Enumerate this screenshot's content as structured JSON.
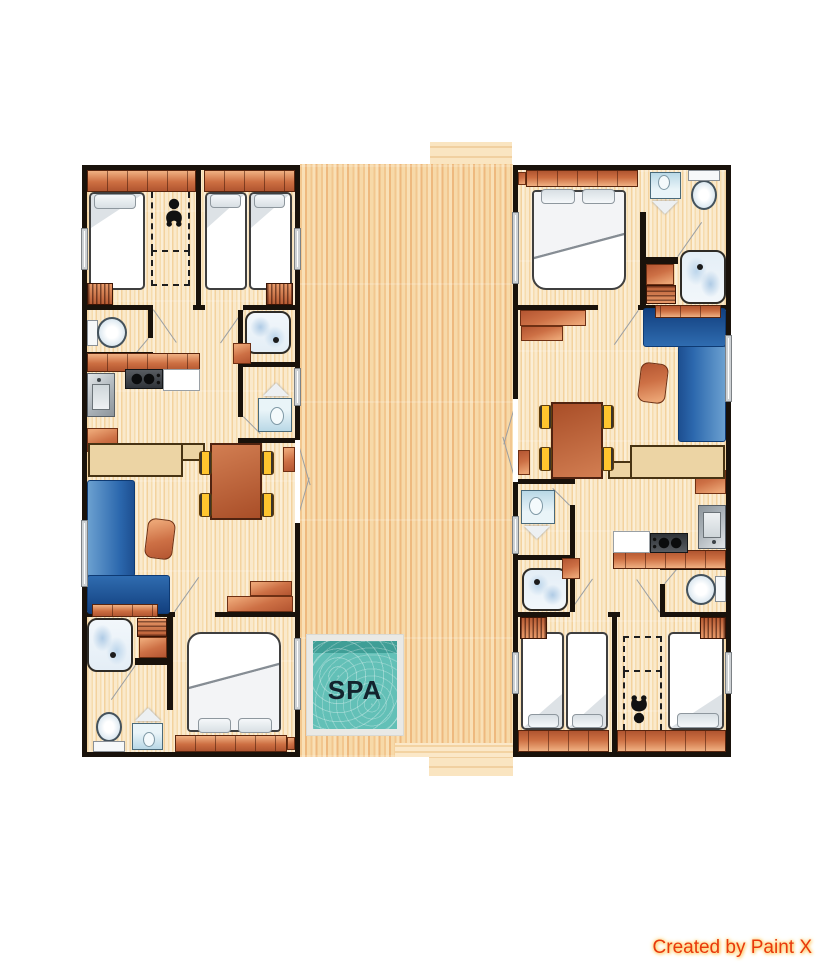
{
  "image_type": "holiday-home floor plan, two mirrored units around a central terrace",
  "labels": {
    "spa": "SPA"
  },
  "credit": {
    "text": "Created by Paint X"
  },
  "colors": {
    "background": "#ffffff",
    "walls": "#19120b",
    "unit_floor": "#fae9cb",
    "deck_wood": "#f7d9a8",
    "furniture_orange": "#cd7045",
    "sofa_blue": "#2b67ad",
    "chair_yellow": "#ffc52e",
    "table_brown": "#a94e28",
    "spa_water": "#63c0b7",
    "spa_water_dark": "#3f9e96",
    "spa_border": "#e9e9e6",
    "fixture_blue": "#b9d8e6",
    "credit_text": "#e8380c"
  },
  "deck": {
    "name": "central-terrace",
    "features": [
      "spa-pool",
      "top-step",
      "bottom-step"
    ]
  },
  "units": [
    {
      "id": "unit-left",
      "rotation_deg": 0,
      "rooms": [
        "twin-bedroom-with-baby-cot",
        "twin-bedroom",
        "wc",
        "shower-room",
        "kitchen",
        "washbasin-room",
        "living-dining",
        "bathroom",
        "double-bedroom"
      ],
      "furniture": [
        "single-bed",
        "single-bed",
        "single-bed",
        "baby-cot-area",
        "wardrobe",
        "wardrobe",
        "toilet",
        "shower",
        "kitchen-cabinets",
        "stove",
        "kitchen-sink",
        "counter",
        "fridge-cabinet",
        "washbasin-with-mirror",
        "dining-table",
        "chair",
        "chair",
        "chair",
        "chair",
        "stool",
        "corner-sofa",
        "armchair",
        "tv-cabinet",
        "shower",
        "towel-shelf",
        "toilet",
        "washbasin-with-mirror",
        "double-bed",
        "french-doors-to-terrace"
      ]
    },
    {
      "id": "unit-right",
      "rotation_deg": 180,
      "rooms": [
        "twin-bedroom-with-baby-cot",
        "twin-bedroom",
        "wc",
        "shower-room",
        "kitchen",
        "washbasin-room",
        "living-dining",
        "bathroom",
        "double-bedroom"
      ],
      "furniture": [
        "identical to unit-left, rotated 180 degrees"
      ]
    }
  ]
}
